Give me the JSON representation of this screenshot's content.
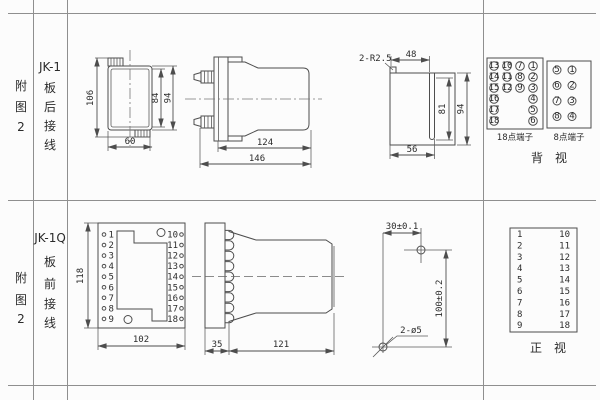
{
  "sheet": {
    "row1": {
      "fig_no": [
        "附",
        "图",
        "2"
      ],
      "model": "JK-1",
      "wiring": [
        "板",
        "后",
        "接",
        "线"
      ],
      "front_dims": {
        "height": "106",
        "inner_height": "84",
        "outer_height": "94",
        "width": "60"
      },
      "side_dims": {
        "depth": "124",
        "total_depth": "146"
      },
      "cutout": {
        "radius_note": "2-R2.5",
        "top_width": "48",
        "slot_height": "81",
        "height": "94",
        "bottom_width": "56"
      },
      "rear_view": {
        "t18": {
          "label": "18点端子",
          "rows": [
            [
              "13",
              "10",
              "7",
              "1"
            ],
            [
              "14",
              "11",
              "8",
              "2"
            ],
            [
              "15",
              "12",
              "9",
              "3"
            ],
            [
              "16",
              "",
              "",
              "4"
            ],
            [
              "17",
              "",
              "",
              "5"
            ],
            [
              "18",
              "",
              "",
              "6"
            ]
          ]
        },
        "t8": {
          "label": "8点端子",
          "rows": [
            [
              "5",
              "1"
            ],
            [
              "6",
              "2"
            ],
            [
              "7",
              "3"
            ],
            [
              "8",
              "4"
            ]
          ]
        },
        "caption": "背　视"
      }
    },
    "row2": {
      "fig_no": [
        "附",
        "图",
        "2"
      ],
      "model": "JK-1Q",
      "wiring": [
        "板",
        "前",
        "接",
        "线"
      ],
      "front_view": {
        "left": [
          "1",
          "2",
          "3",
          "4",
          "5",
          "6",
          "7",
          "8",
          "9"
        ],
        "right": [
          "10",
          "11",
          "12",
          "13",
          "14",
          "15",
          "16",
          "17",
          "18"
        ],
        "height": "118",
        "width": "102"
      },
      "side_dims": {
        "plate": "35",
        "body": "121"
      },
      "drill": {
        "x": "30±0.1",
        "y": "100±0.2",
        "holes": "2-ø5"
      },
      "table": {
        "left": [
          "1",
          "2",
          "3",
          "4",
          "5",
          "6",
          "7",
          "8",
          "9"
        ],
        "right": [
          "10",
          "11",
          "12",
          "13",
          "14",
          "15",
          "16",
          "17",
          "18"
        ],
        "caption": "正　视"
      }
    }
  }
}
